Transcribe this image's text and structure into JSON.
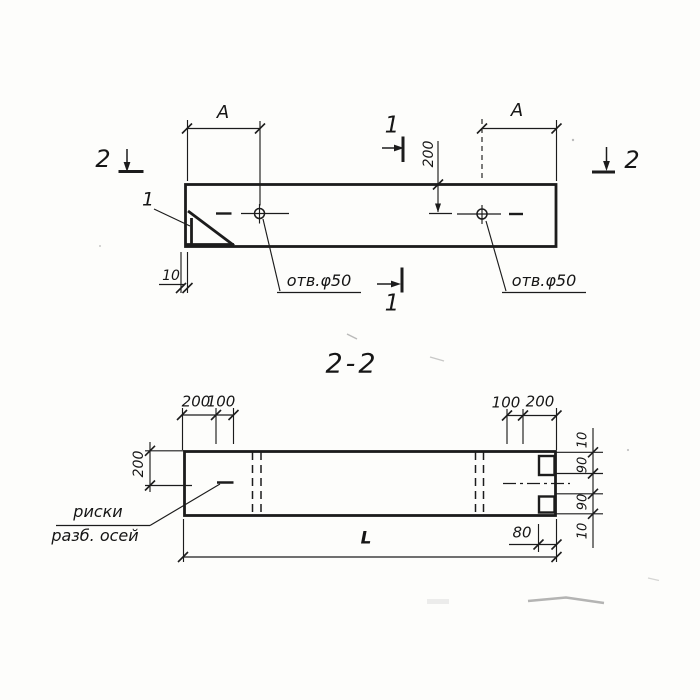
{
  "drawing": {
    "title": "2-2",
    "plan": {
      "dim_a_left": "A",
      "dim_a_right": "A",
      "dim_200": "200",
      "dim_10": "10",
      "hole_left": "отв.φ50",
      "hole_right": "отв.φ50",
      "detail_mark": "1",
      "cut1_top": "1",
      "cut1_bottom": "1",
      "cut2_left": "2",
      "cut2_right": "2"
    },
    "section": {
      "dim_200_top_left": "200",
      "dim_100_top_left": "100",
      "dim_100_top_right": "100",
      "dim_200_top_right": "200",
      "dim_200_side": "200",
      "dim_10_top": "10",
      "dim_90_upper": "90",
      "dim_90_lower": "90",
      "dim_10_bottom": "10",
      "dim_80": "80",
      "dim_length": "L",
      "axis_note_line1": "риски",
      "axis_note_line2": "разб. осей"
    }
  }
}
